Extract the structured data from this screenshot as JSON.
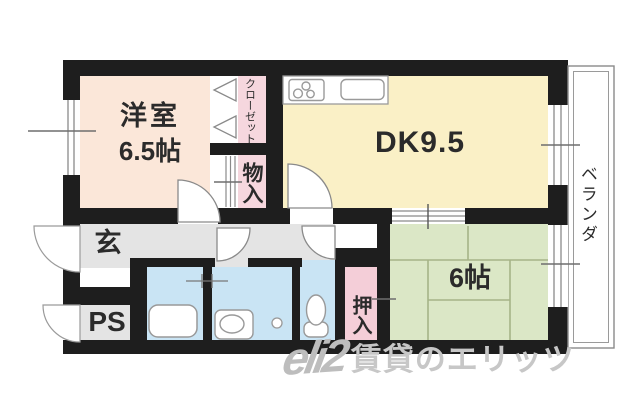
{
  "rooms": {
    "western_room": {
      "name_label": "洋室",
      "size_label": "6.5帖"
    },
    "dining_kitchen": {
      "label": "DK9.5"
    },
    "japanese_room": {
      "label": "6帖"
    },
    "closet": {
      "label": "クローゼット"
    },
    "storage": {
      "label": "物入"
    },
    "futon_closet": {
      "label": "押入"
    },
    "entrance": {
      "label": "玄"
    },
    "pipe_space": {
      "label": "PS"
    },
    "veranda": {
      "label": "ベランダ"
    }
  },
  "fixtures": {
    "stove": "stove-icon",
    "kitchen_sink": "kitchen-sink-icon",
    "bathtub": "bathtub-icon",
    "vanity": "vanity-sink-icon",
    "toilet": "toilet-icon",
    "washer_outlet": "washer-outlet-icon"
  },
  "watermark": {
    "logo": "eli2",
    "text": "賃貸のエリッツ"
  },
  "colors": {
    "peach": "#fbe7d9",
    "cream": "#faf0c6",
    "pink": "#f6d7de",
    "pink2": "#f4ced8",
    "green": "#dbe7c6",
    "tatami_line": "#a6b487",
    "blue": "#c9e4f4",
    "gray": "#e4e4e4",
    "wall": "#1e1e1e",
    "label": "#2b2b2b",
    "outline": "#8a8a8a",
    "watermark": "#c7c7c7"
  }
}
